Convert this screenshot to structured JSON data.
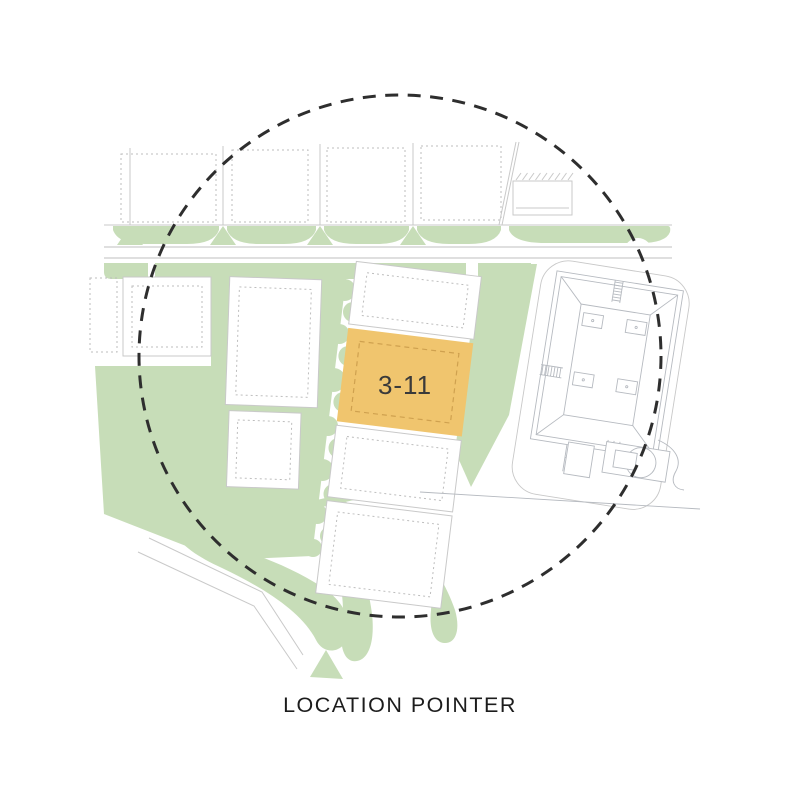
{
  "caption": {
    "label": "LOCATION POINTER"
  },
  "map": {
    "highlighted_plot": {
      "id": "3-11"
    },
    "colors": {
      "background": "#ffffff",
      "green": "#c7ddb8",
      "highlight_fill": "#f0c56e",
      "highlight_dash": "#cfa14f",
      "road_line": "#bfbfbf",
      "building_line": "#b6bac0",
      "site_outline": "#c8c8c8",
      "circle_dash": "#2e2e2e",
      "label_text": "#3a3a3a",
      "caption_text": "#1c1c1c"
    }
  }
}
